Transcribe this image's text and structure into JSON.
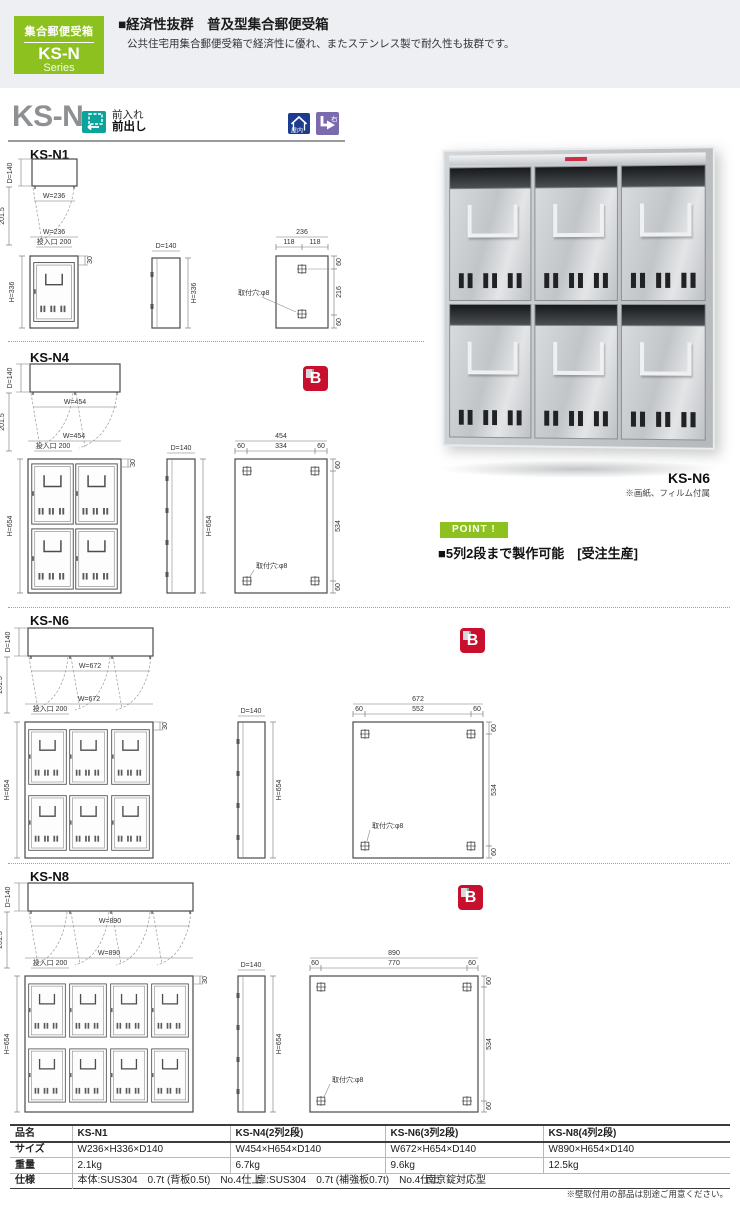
{
  "header": {
    "series_box": {
      "category": "集合郵便受箱",
      "model": "KS-N",
      "series": "Series"
    },
    "headline": "■経済性抜群　普及型集合郵便受箱",
    "description": "公共住宅用集合郵便受箱で経済性に優れ、またステンレス製で耐久性も抜群です。"
  },
  "title_row": {
    "model": "KS-N",
    "front_in": "前入れ",
    "front_out": "前出し",
    "indoor": "屋内",
    "right": "右"
  },
  "common": {
    "depth": "D=140",
    "swing": "201.5",
    "slot": "投入口 200",
    "slot_offset": "30",
    "hole": "取付穴:φ8"
  },
  "sections": {
    "n1": {
      "name": "KS-N1",
      "width": "W=236",
      "height": "H=336",
      "back": {
        "total": "236",
        "segs": [
          "118",
          "118"
        ],
        "top": "60",
        "mid": "216",
        "bottom": "60"
      }
    },
    "n4": {
      "name": "KS-N4",
      "width": "W=454",
      "height": "H=654",
      "back": {
        "total": "454",
        "segs": [
          "60",
          "334",
          "60"
        ],
        "top": "60",
        "mid": "534",
        "bottom": "60"
      }
    },
    "n6": {
      "name": "KS-N6",
      "width": "W=672",
      "height": "H=654",
      "back": {
        "total": "672",
        "segs": [
          "60",
          "552",
          "60"
        ],
        "top": "60",
        "mid": "534",
        "bottom": "60"
      }
    },
    "n8": {
      "name": "KS-N8",
      "width": "W=890",
      "height": "H=654",
      "back": {
        "total": "890",
        "segs": [
          "60",
          "770",
          "60"
        ],
        "top": "60",
        "mid": "534",
        "bottom": "60"
      }
    }
  },
  "b_mark": "B",
  "photo": {
    "caption": "KS-N6",
    "note": "※画紙、フィルム付属"
  },
  "point": {
    "badge": "POINT !",
    "text": "■5列2段まで製作可能　[受注生産]"
  },
  "table": {
    "row_labels": [
      "品名",
      "サイズ",
      "重量",
      "仕様"
    ],
    "products": [
      {
        "name": "KS-N1",
        "size": "W236×H336×D140",
        "weight": "2.1kg"
      },
      {
        "name": "KS-N4(2列2段)",
        "size": "W454×H654×D140",
        "weight": "6.7kg"
      },
      {
        "name": "KS-N6(3列2段)",
        "size": "W672×H654×D140",
        "weight": "9.6kg"
      },
      {
        "name": "KS-N8(4列2段)",
        "size": "W890×H654×D140",
        "weight": "12.5kg"
      }
    ],
    "spec_body": "本体:SUS304　0.7t (背板0.5t)　No.4仕上",
    "spec_door": "扉:SUS304　0.7t (補強板0.7t)　No.4仕上",
    "spec_lock": "南京錠対応型"
  },
  "footnote": "※壁取付用の部品は別途ご用意ください。",
  "colors": {
    "accent_green": "#8cc11f",
    "badge_red": "#c8102e",
    "icon_blue": "#1d3c90",
    "icon_purple": "#7c6aae",
    "icon_teal": "#0ba39b"
  }
}
